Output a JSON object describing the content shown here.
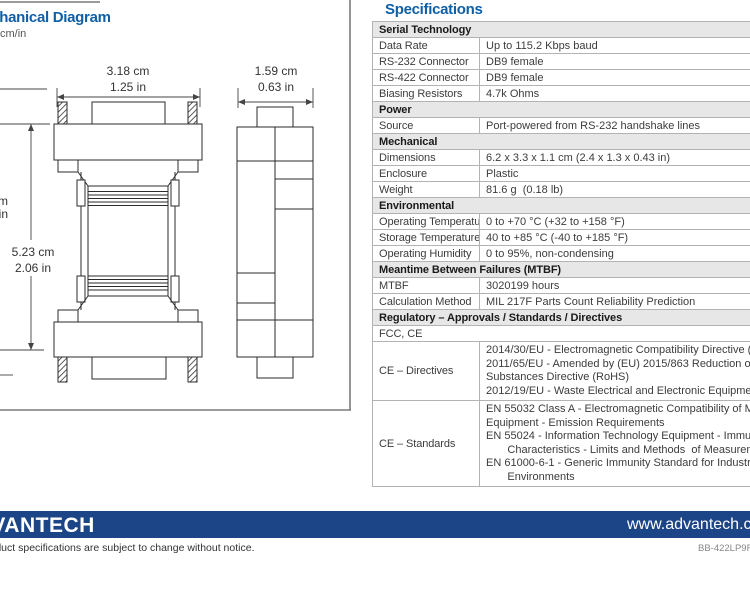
{
  "colors": {
    "accent_blue": "#0e5fa6",
    "footer_blue": "#1c4587",
    "section_header_bg": "#e7e7e7",
    "table_border": "#b3b3b3"
  },
  "headings": {
    "mechanical": "Mechanical Diagram",
    "units": "cm/in",
    "specifications": "Specifications"
  },
  "diagram": {
    "front_width": {
      "cm": "3.18 cm",
      "inch": "1.25 in"
    },
    "front_height": {
      "cm": "5.23 cm",
      "inch": "2.06 in"
    },
    "side_width": {
      "cm": "1.59 cm",
      "inch": "0.63 in"
    },
    "left_cut_dim": {
      "cm": "cm",
      "inch": "in"
    }
  },
  "spec_rows": [
    {
      "t": "h",
      "label": "Serial Technology"
    },
    {
      "t": "kv",
      "label": "Data Rate",
      "value": "Up to 115.2 Kbps baud"
    },
    {
      "t": "kv",
      "label": "RS-232 Connector",
      "value": "DB9 female"
    },
    {
      "t": "kv",
      "label": "RS-422 Connector",
      "value": "DB9 female"
    },
    {
      "t": "kv",
      "label": "Biasing Resistors",
      "value": "4.7k Ohms"
    },
    {
      "t": "h",
      "label": "Power"
    },
    {
      "t": "kv",
      "label": "Source",
      "value": "Port-powered from RS-232 handshake lines"
    },
    {
      "t": "h",
      "label": "Mechanical"
    },
    {
      "t": "kv",
      "label": "Dimensions",
      "value": "6.2 x 3.3 x 1.1 cm (2.4 x 1.3 x 0.43 in)"
    },
    {
      "t": "kv",
      "label": "Enclosure",
      "value": "Plastic"
    },
    {
      "t": "kv",
      "label": "Weight",
      "value": "81.6 g  (0.18 lb)"
    },
    {
      "t": "h",
      "label": "Environmental"
    },
    {
      "t": "kv",
      "label": "Operating Temperature",
      "value": "0 to +70 °C (+32 to +158 °F)"
    },
    {
      "t": "kv",
      "label": "Storage Temperature",
      "value": "40 to +85 °C (-40 to +185 °F)"
    },
    {
      "t": "kv",
      "label": "Operating Humidity",
      "value": "0 to 95%, non-condensing"
    },
    {
      "t": "h",
      "label": "Meantime Between Failures (MTBF)"
    },
    {
      "t": "kv",
      "label": "MTBF",
      "value": "3020199 hours"
    },
    {
      "t": "kv",
      "label": "Calculation Method",
      "value": "MIL 217F Parts Count Reliability Prediction"
    },
    {
      "t": "h",
      "label": "Regulatory – Approvals / Standards / Directives"
    },
    {
      "t": "span",
      "label": "FCC, CE"
    },
    {
      "t": "kv",
      "multi": true,
      "label": "CE – Directives",
      "value": "2014/30/EU - Electromagnetic Compatibility Directive (EMC)\n2011/65/EU - Amended by (EU) 2015/863 Reduction of Hazardous\nSubstances Directive (RoHS)\n2012/19/EU - Waste Electrical and Electronic Equipment (WEEE)"
    },
    {
      "t": "kv",
      "multi": true,
      "label": "CE – Standards",
      "value": "EN 55032 Class A - Electromagnetic Compatibility of Multimedia\nEquipment - Emission Requirements\nEN 55024 - Information Technology Equipment - Immunity\n       Characteristics - Limits and Methods  of Measurement\nEN 61000-6-1 - Generic Immunity Standard for Industrial\n       Environments"
    }
  ],
  "footer": {
    "logo": "ADVANTECH",
    "website": "www.advantech.com",
    "disclaimer": "Product specifications are subject to change without notice.",
    "doc_code": "BB-422LP9R_"
  }
}
